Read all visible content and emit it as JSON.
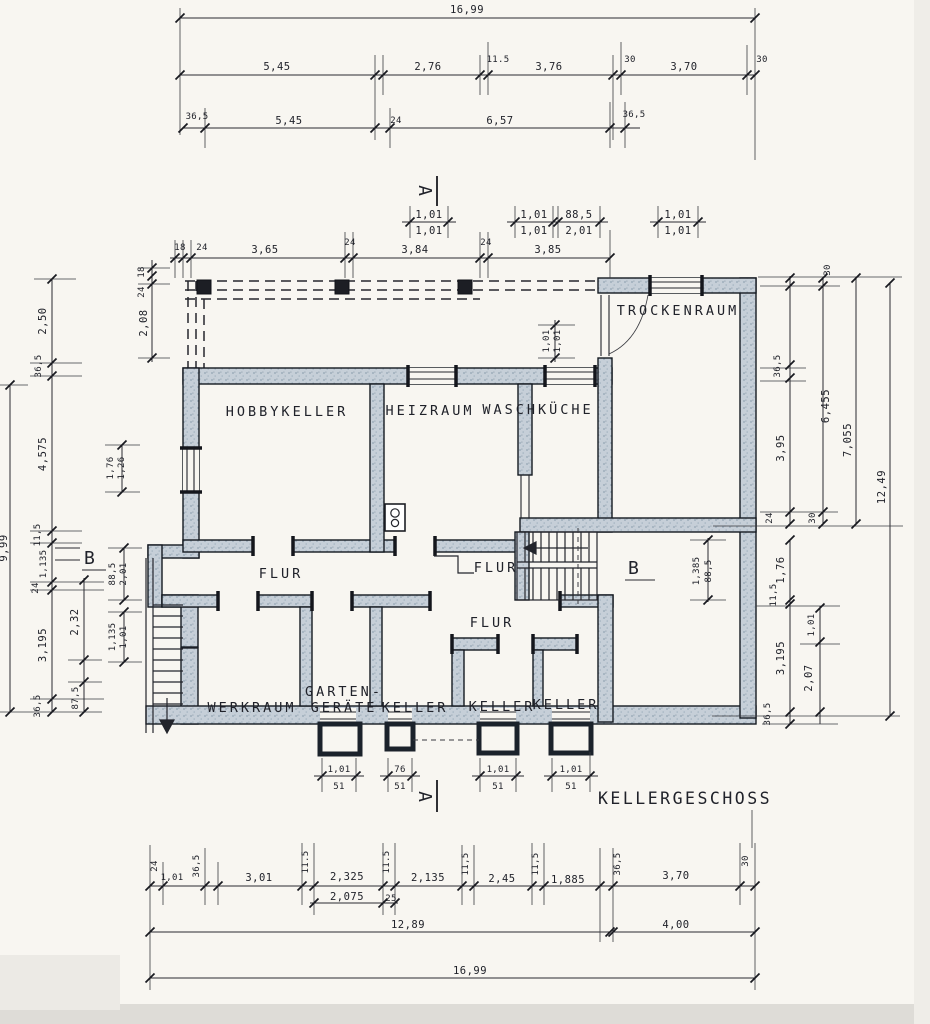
{
  "title": "KELLERGESCHOSS",
  "sections": {
    "a": "A",
    "b": "B"
  },
  "rooms": {
    "trockenraum": "TROCKENRAUM",
    "hobbykeller": "HOBBYKELLER",
    "heizraum": "HEIZRAUM",
    "waschkueche": "WASCHKÜCHE",
    "flur1": "FLUR",
    "flur2": "FLUR",
    "flur3": "FLUR",
    "werkraum": "WERKRAUM",
    "garten1": "GARTEN-",
    "garten2": "GERÄTE",
    "keller1": "KELLER",
    "keller2": "KELLER",
    "keller3": "KELLER"
  },
  "dims": {
    "top": [
      "16,99",
      "5,45",
      "2,76",
      "11.5",
      "3,76",
      "30",
      "3,70",
      "30",
      "36,5",
      "5,45",
      "24",
      "6,57",
      "36,5"
    ],
    "pairs_top": [
      [
        "1,01",
        "1,01"
      ],
      [
        "1,01",
        "1,01"
      ],
      [
        "88,5",
        "2,01"
      ],
      [
        "1,01",
        "1,01"
      ]
    ],
    "terrace": [
      "18",
      "24",
      "3,65",
      "24",
      "3,84",
      "24",
      "3,85",
      "18",
      "24",
      "2,08",
      "1,01",
      "1,01"
    ],
    "left": [
      "9,99",
      "2,50",
      "36,5",
      "4,575",
      "11,5",
      "1,135",
      "24",
      "3,195",
      "36,5",
      "1,76",
      "1,26",
      "88,5",
      "2,01",
      "1,135",
      "1,01",
      "2,32",
      "87,5"
    ],
    "right": [
      "30",
      "36,5",
      "3,95",
      "24",
      "6,455",
      "30",
      "7,055",
      "12,49",
      "1,76",
      "11,5",
      "3,195",
      "36,5",
      "1,01",
      "2,07",
      "1,385",
      "88,5"
    ],
    "wells": [
      [
        "1,01",
        "51"
      ],
      [
        "76",
        "51"
      ],
      [
        "1,01",
        "51"
      ],
      [
        "1,01",
        "51"
      ]
    ],
    "bottom": [
      "24",
      "1,01",
      "36,5",
      "3,01",
      "11.5",
      "2,325",
      "11.5",
      "2,135",
      "11,5",
      "2,45",
      "11,5",
      "1,885",
      "36,5",
      "3,70",
      "30",
      "2,075",
      "25",
      "12,89",
      "4,00",
      "16,99"
    ]
  },
  "colors": {
    "paper": "#f8f6f1",
    "ink": "#23242a",
    "wall_fill": "#c6cfd8",
    "wall_edge": "#141a21"
  }
}
